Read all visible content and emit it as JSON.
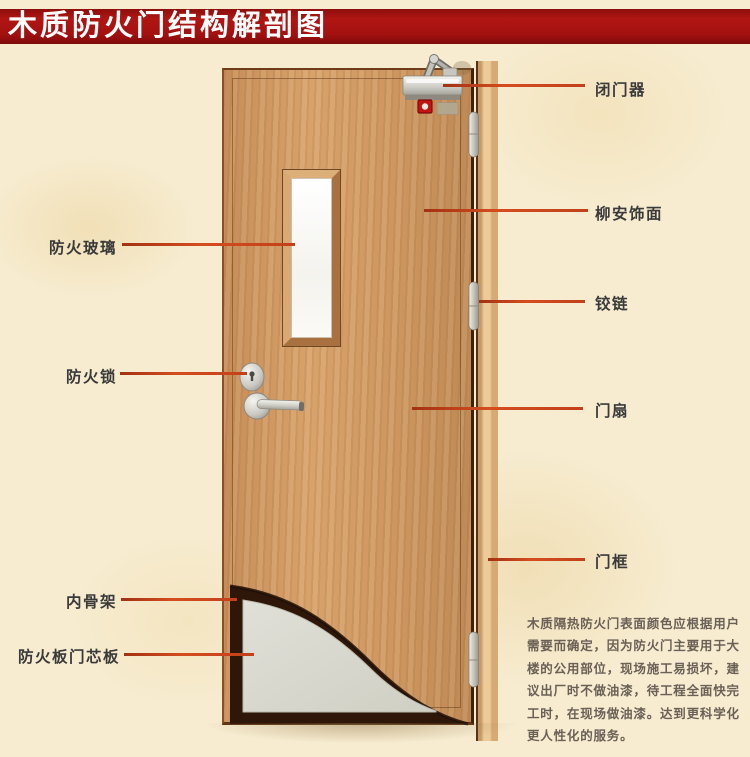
{
  "title": "木质防火门结构解剖图",
  "annotations": {
    "left": [
      {
        "text": "防火玻璃"
      },
      {
        "text": "防火锁"
      },
      {
        "text": "内骨架"
      },
      {
        "text": "防火板门芯板"
      }
    ],
    "right": [
      {
        "text": "闭门器"
      },
      {
        "text": "柳安饰面"
      },
      {
        "text": "铰链"
      },
      {
        "text": "门扇"
      },
      {
        "text": "门框"
      }
    ]
  },
  "description": {
    "lines": [
      "木质隔热防火门表面颜色应根据用户",
      "需要而确定，因为防火门主要用于大",
      "楼的公用部位，现场施工易损坏，建",
      "议出厂时不做油漆，待工程全面快完",
      "工时，在现场做油漆。达到更科学化",
      "更人性化的服务。"
    ]
  },
  "colors": {
    "banner": "#a31110",
    "leader_line": "#c8421c",
    "door_wood": "#cd9763",
    "frame_wood": "#e2b988",
    "core_panel": "#d9d9d0",
    "skeleton_dark": "#2e1708",
    "background": "#f7ecd0"
  }
}
